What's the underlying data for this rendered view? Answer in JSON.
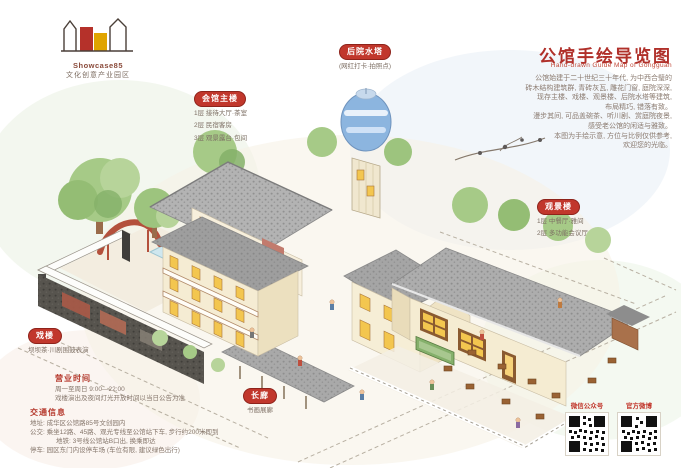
{
  "logo": {
    "line1": "Showcase85",
    "line2": "文化创意产业园区"
  },
  "header": {
    "title": "公馆手绘导览图",
    "subtitle": "Hand-drawn Guide Map of Gongguan",
    "intro_lines": [
      "公馆始建于二十世纪三十年代, 为中西合璧的",
      "砖木结构建筑群, 青砖灰瓦, 雕花门窗, 庭院深深,",
      "现存主楼、戏楼、观景楼、后院水塔等建筑,",
      "布局精巧, 错落有致。",
      "漫步其间, 可品盖碗茶、听川剧、赏庭院夜景,",
      "感受老公馆的闲适与雅致。",
      "本图为手绘示意, 方位与比例仅供参考,",
      "欢迎您的光临。"
    ]
  },
  "labels": {
    "main_building": {
      "title": "会馆主楼",
      "lines": [
        "1层 接待大厅·茶室",
        "2层 民宿客房",
        "3层 观景露台·包间"
      ]
    },
    "water_tower": {
      "title": "后院水塔",
      "line": "(网红打卡·拍照点)"
    },
    "view_tower": {
      "title": "观景楼",
      "lines": [
        "1层 中餐厅·雅间",
        "2层 多功能会议厅"
      ]
    },
    "stage": {
      "title": "戏楼",
      "line": "坝坝茶·川剧围鼓表演"
    },
    "corridor": {
      "title": "长廊",
      "line": "书画展廊"
    }
  },
  "info": {
    "hours": {
      "title": "营业时间",
      "lines": [
        "周一至周日 9:00—22:00",
        "戏楼演出及夜间灯光开放时间以当日公告为准"
      ]
    },
    "traffic": {
      "title": "交通信息",
      "lines": [
        "地址: 成华区公馆路85号文创园内",
        "公交: 乘坐12路、45路、观光专线至公馆站下车, 步行约200米即到",
        "地铁: 3号线公馆站B口出, 换乘即达",
        "停车: 园区东门内设停车场 (车位有限, 建议绿色出行)"
      ]
    }
  },
  "qr": {
    "left_label": "微信公众号",
    "right_label": "官方微博"
  },
  "colors": {
    "title_red": "#b0302a",
    "pill_red": "#c1372c",
    "text_brown": "#85766b",
    "roof_gray": "#a9a9a9",
    "wall_cream": "#f5ecd3",
    "window_yellow": "#f3c64f",
    "dark_wall": "#57544e",
    "tank_blue": "#8cb5df",
    "tree_green": "#a6ca87",
    "slide_red": "#b4503c",
    "sign_green": "#85b06b"
  }
}
